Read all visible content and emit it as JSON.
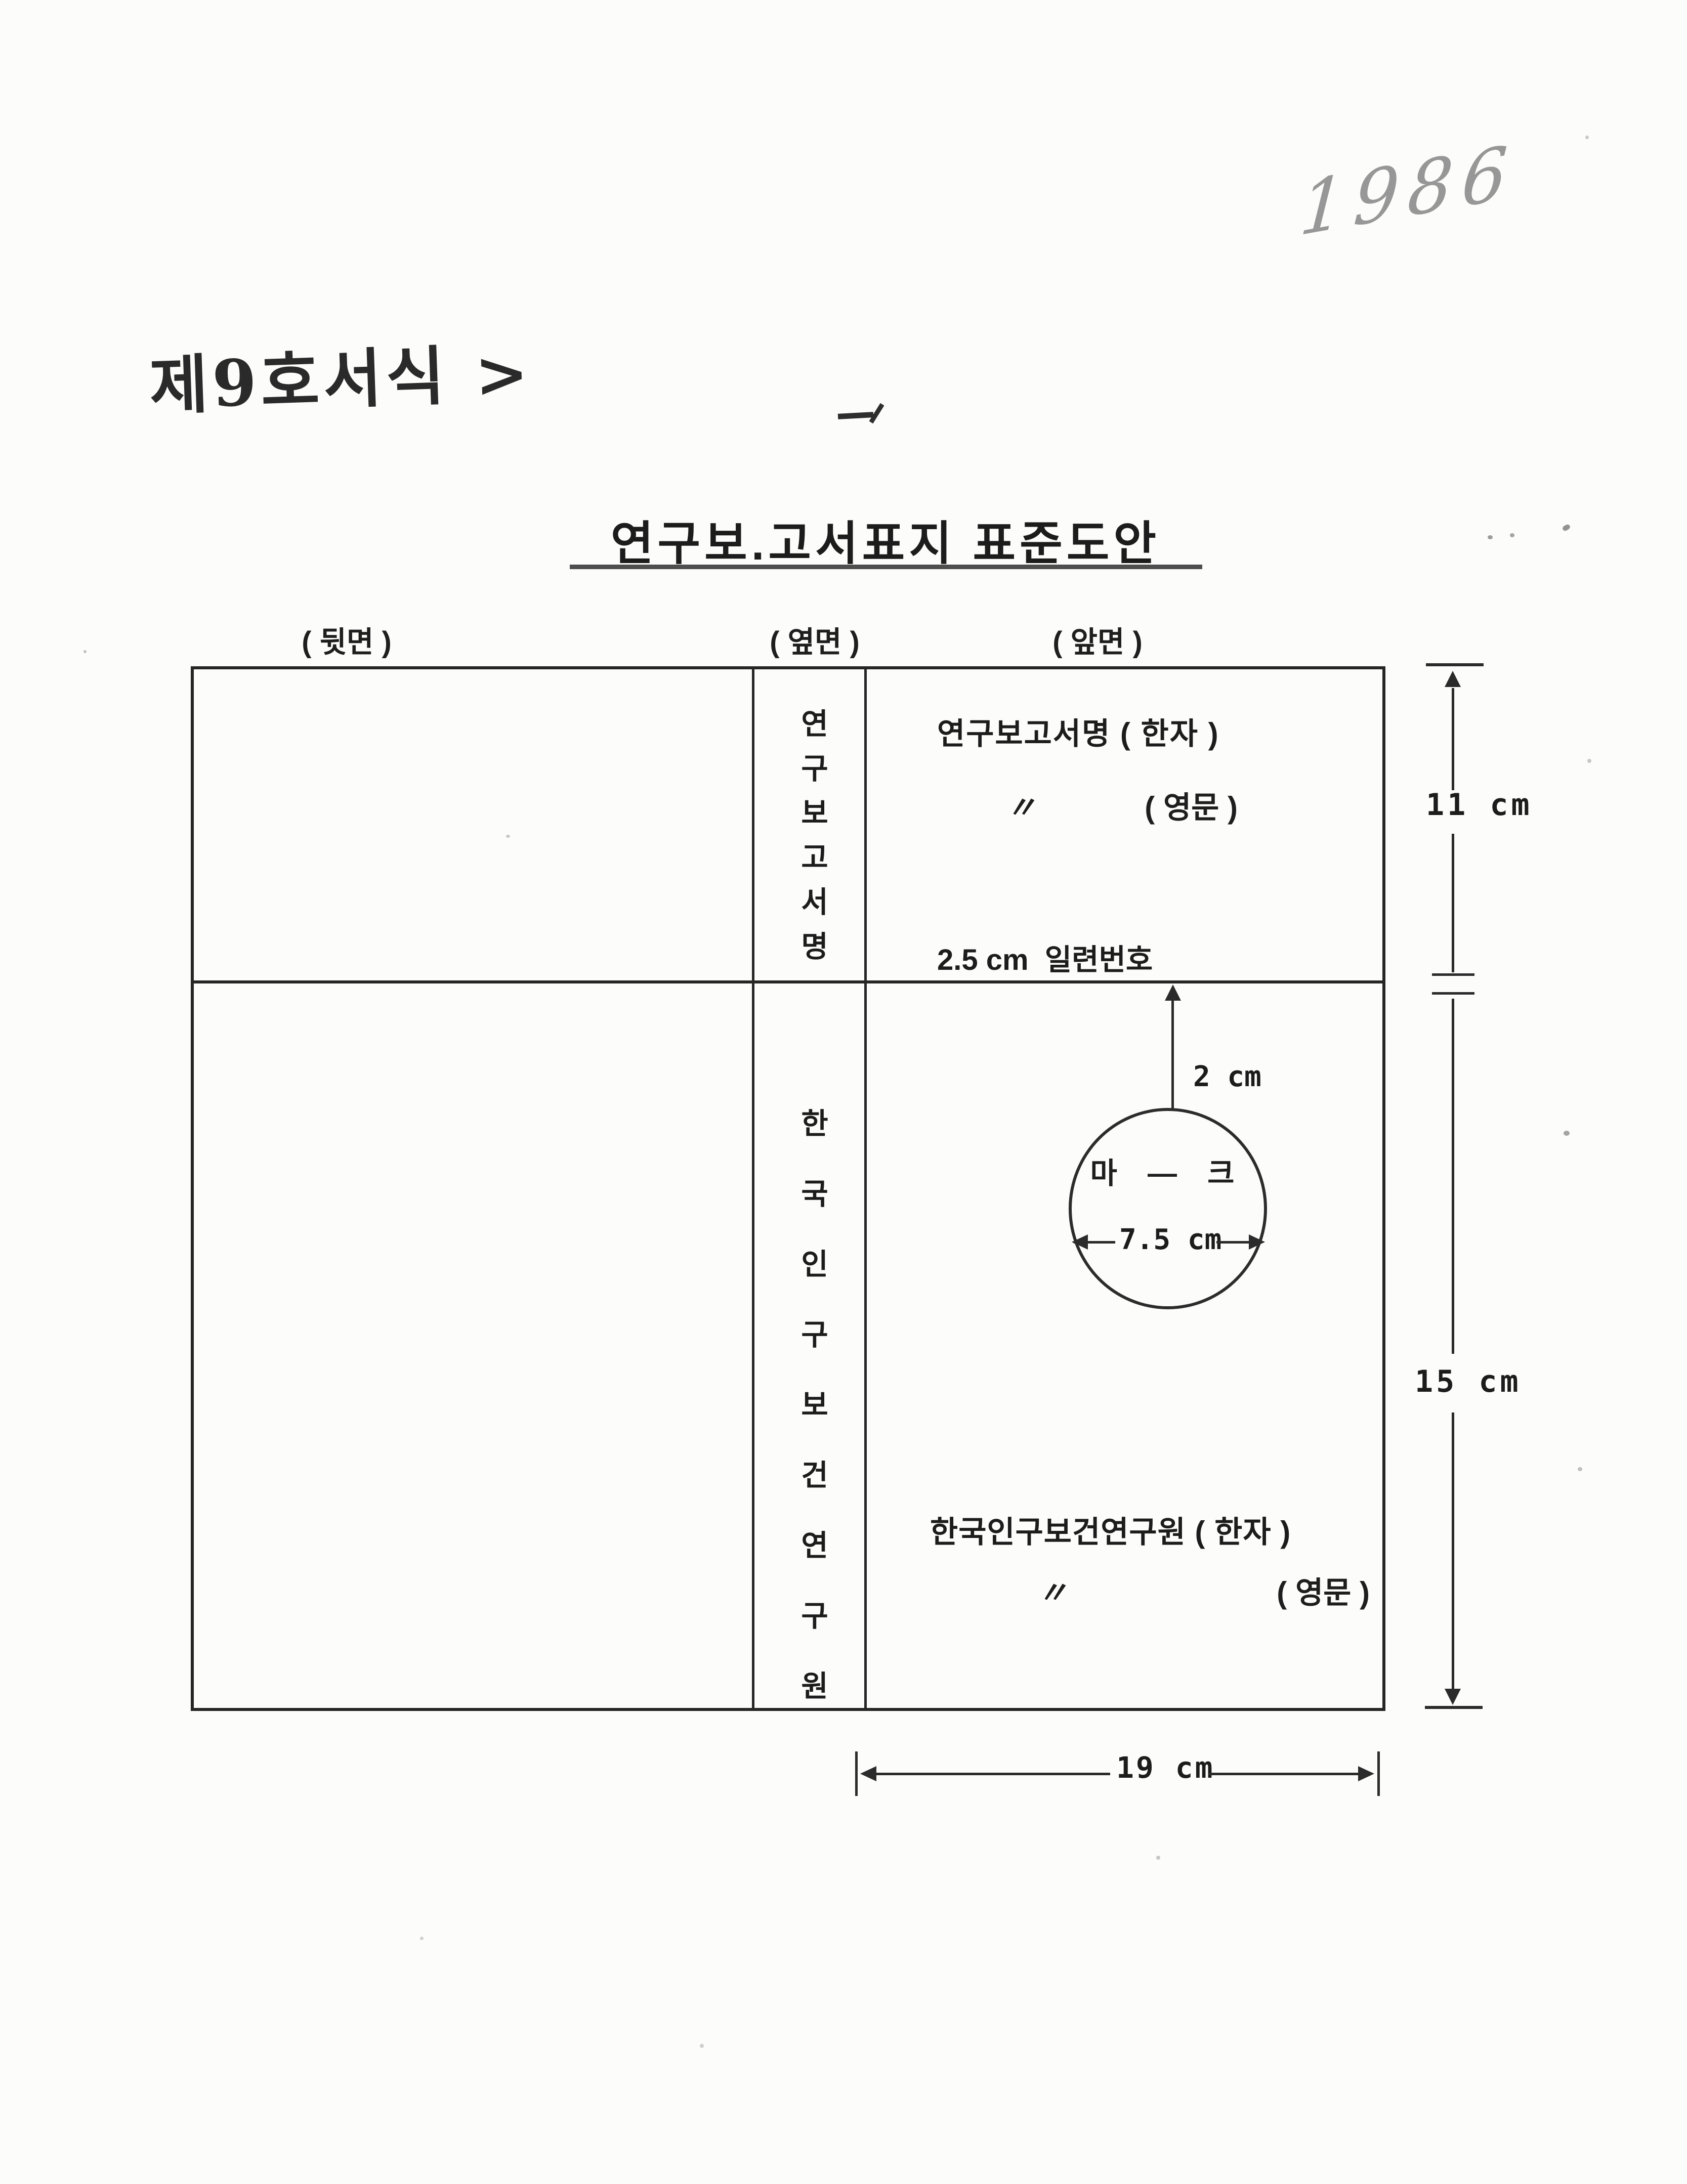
{
  "annotations": {
    "year": "1986",
    "form_label": "제9호서식 >"
  },
  "title": "연구보.고서표지 표준도안",
  "panel_labels": {
    "back": "( 뒷면 )",
    "side": "( 옆면 )",
    "front": "( 앞면 )"
  },
  "spine": {
    "top_text": "연구보고서명",
    "bottom_text": "한국인구보건연구원"
  },
  "front": {
    "report_title_hanja": "연구보고서명 ( 한자 )",
    "ditto": "〃",
    "report_title_english": "( 영문 )",
    "serial_note": "2.5 cm  일련번호",
    "logo_label": "마 ― 크",
    "logo_offset": "2 cm",
    "logo_diameter": "7.5 cm",
    "institute_hanja": "한국인구보건연구원 ( 한자 )",
    "institute_english": "( 영문 )"
  },
  "dimensions": {
    "upper_height": "11 cm",
    "lower_height": "15 cm",
    "cover_width": "19 cm"
  }
}
